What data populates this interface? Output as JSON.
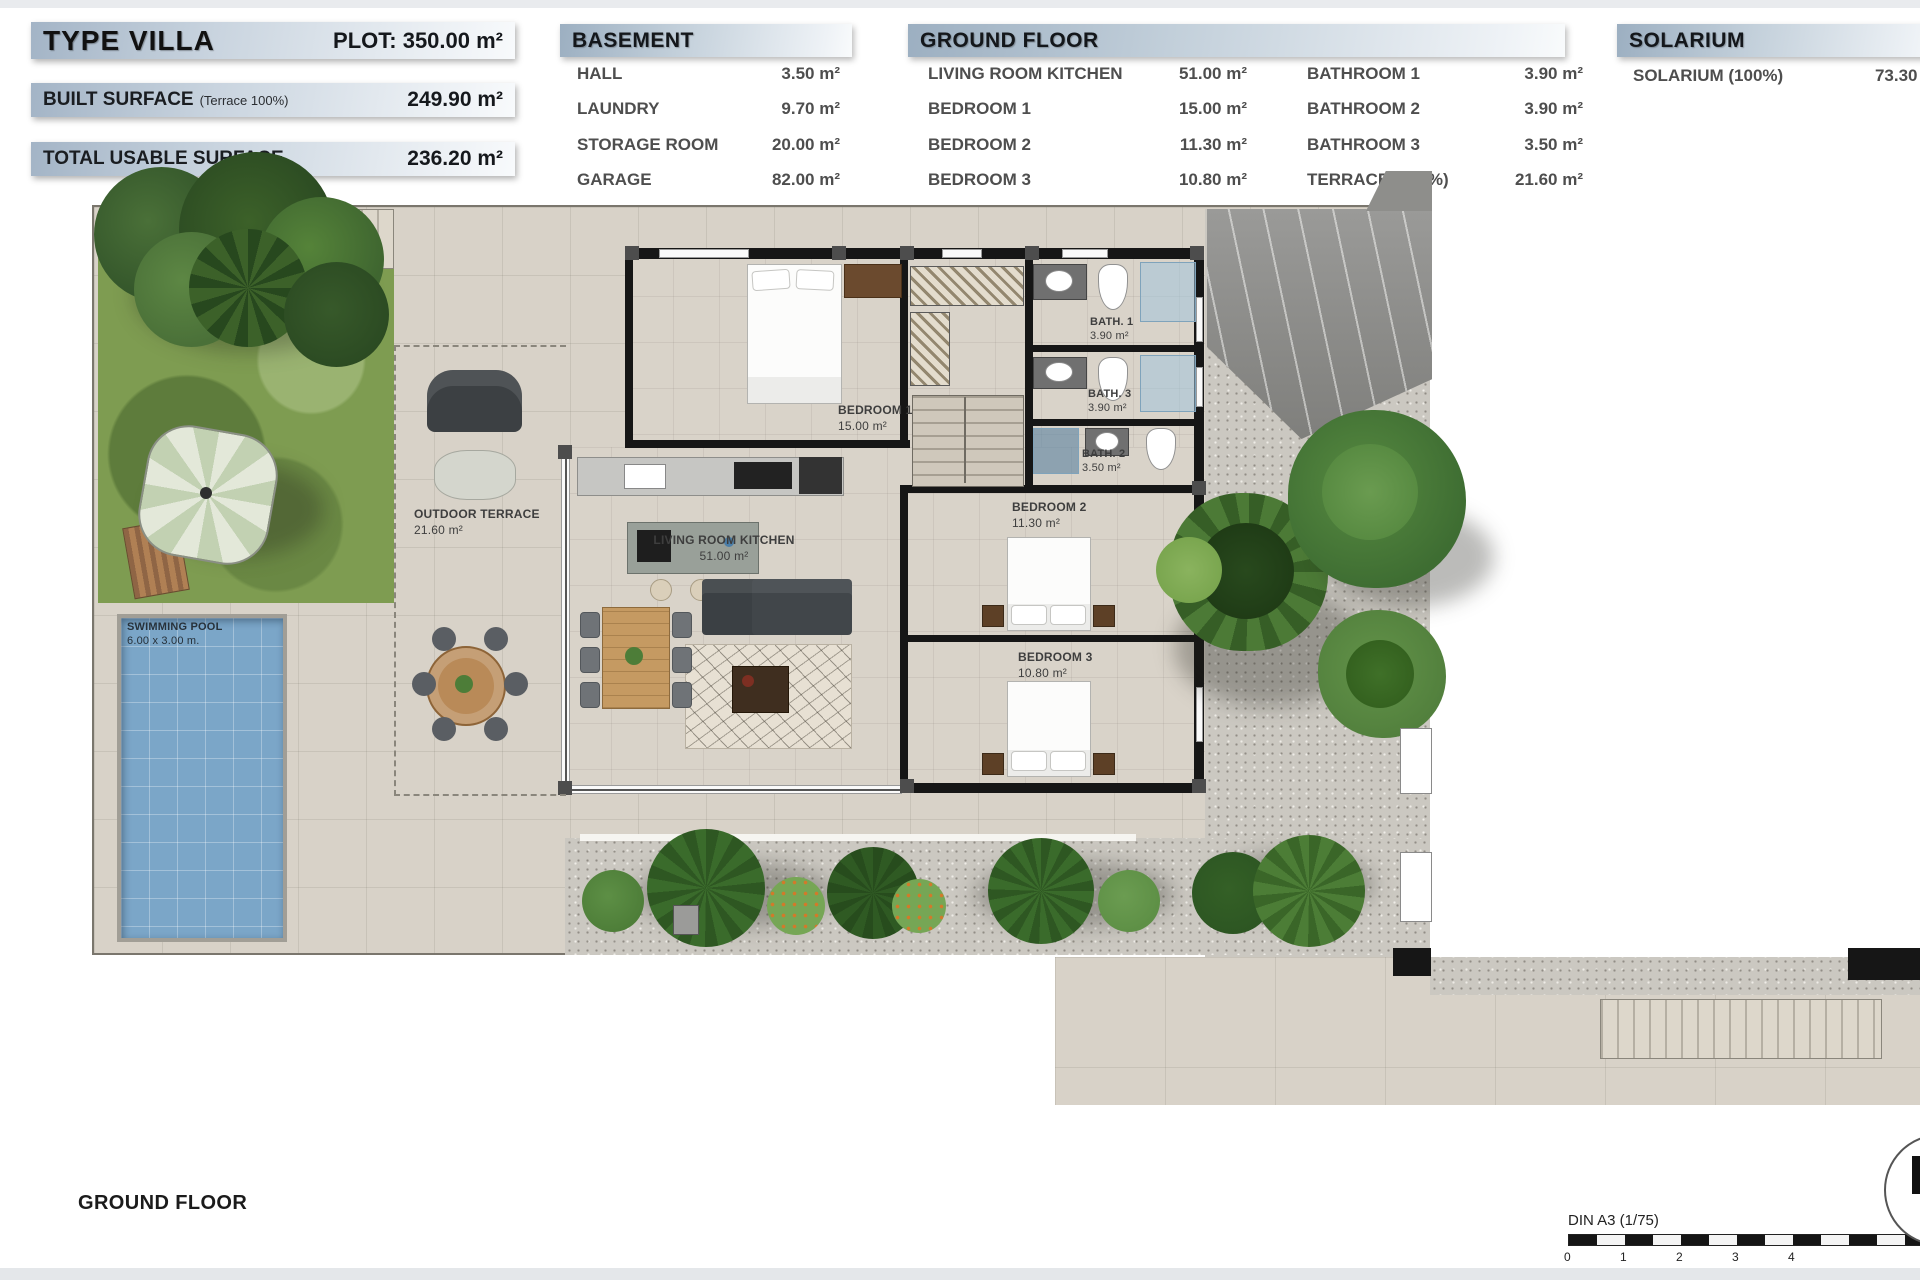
{
  "summary": {
    "type_label": "TYPE VILLA",
    "plot": "PLOT: 350.00 m²",
    "built_label": "BUILT SURFACE",
    "built_note": "(Terrace 100%)",
    "built_value": "249.90 m²",
    "usable_label": "TOTAL USABLE SURFACE",
    "usable_value": "236.20 m²"
  },
  "basement": {
    "title": "BASEMENT",
    "rows": [
      {
        "label": "HALL",
        "value": "3.50 m²"
      },
      {
        "label": "LAUNDRY",
        "value": "9.70 m²"
      },
      {
        "label": "STORAGE ROOM",
        "value": "20.00 m²"
      },
      {
        "label": "GARAGE",
        "value": "82.00 m²"
      }
    ]
  },
  "ground_floor_table": {
    "title": "GROUND FLOOR",
    "left_rows": [
      {
        "label": "LIVING ROOM KITCHEN",
        "value": "51.00 m²"
      },
      {
        "label": "BEDROOM 1",
        "value": "15.00 m²"
      },
      {
        "label": "BEDROOM 2",
        "value": "11.30 m²"
      },
      {
        "label": "BEDROOM 3",
        "value": "10.80 m²"
      }
    ],
    "right_rows": [
      {
        "label": "BATHROOM 1",
        "value": "3.90 m²"
      },
      {
        "label": "BATHROOM 2",
        "value": "3.90 m²"
      },
      {
        "label": "BATHROOM 3",
        "value": "3.50 m²"
      },
      {
        "label": "TERRACE (100%)",
        "value": "21.60 m²"
      }
    ]
  },
  "solarium": {
    "title": "SOLARIUM",
    "rows": [
      {
        "label": "SOLARIUM (100%)",
        "value": "73.30 m²"
      }
    ]
  },
  "plan": {
    "rooms": [
      {
        "name": "BEDROOM 1",
        "area": "15.00 m²"
      },
      {
        "name": "BATH. 1",
        "area": "3.90 m²"
      },
      {
        "name": "BATH. 3",
        "area": "3.90 m²"
      },
      {
        "name": "BATH. 2",
        "area": "3.50 m²"
      },
      {
        "name": "BEDROOM 2",
        "area": "11.30 m²"
      },
      {
        "name": "BEDROOM 3",
        "area": "10.80 m²"
      },
      {
        "name": "LIVING ROOM KITCHEN",
        "area": "51.00 m²"
      },
      {
        "name": "OUTDOOR TERRACE",
        "area": "21.60 m²"
      },
      {
        "name": "SWIMMING POOL",
        "area": "6.00 x 3.00 m."
      }
    ]
  },
  "footer": {
    "title": "GROUND FLOOR",
    "scale_label": "DIN A3 (1/75)",
    "scale_ticks": [
      "0",
      "1",
      "2",
      "3",
      "4"
    ]
  },
  "colors": {
    "header_bar_top": "#a3b4c6",
    "grass": "#7e9c51",
    "pool": "#7ba6c8",
    "driveway": "#8e8e8c",
    "wall": "#161616"
  }
}
